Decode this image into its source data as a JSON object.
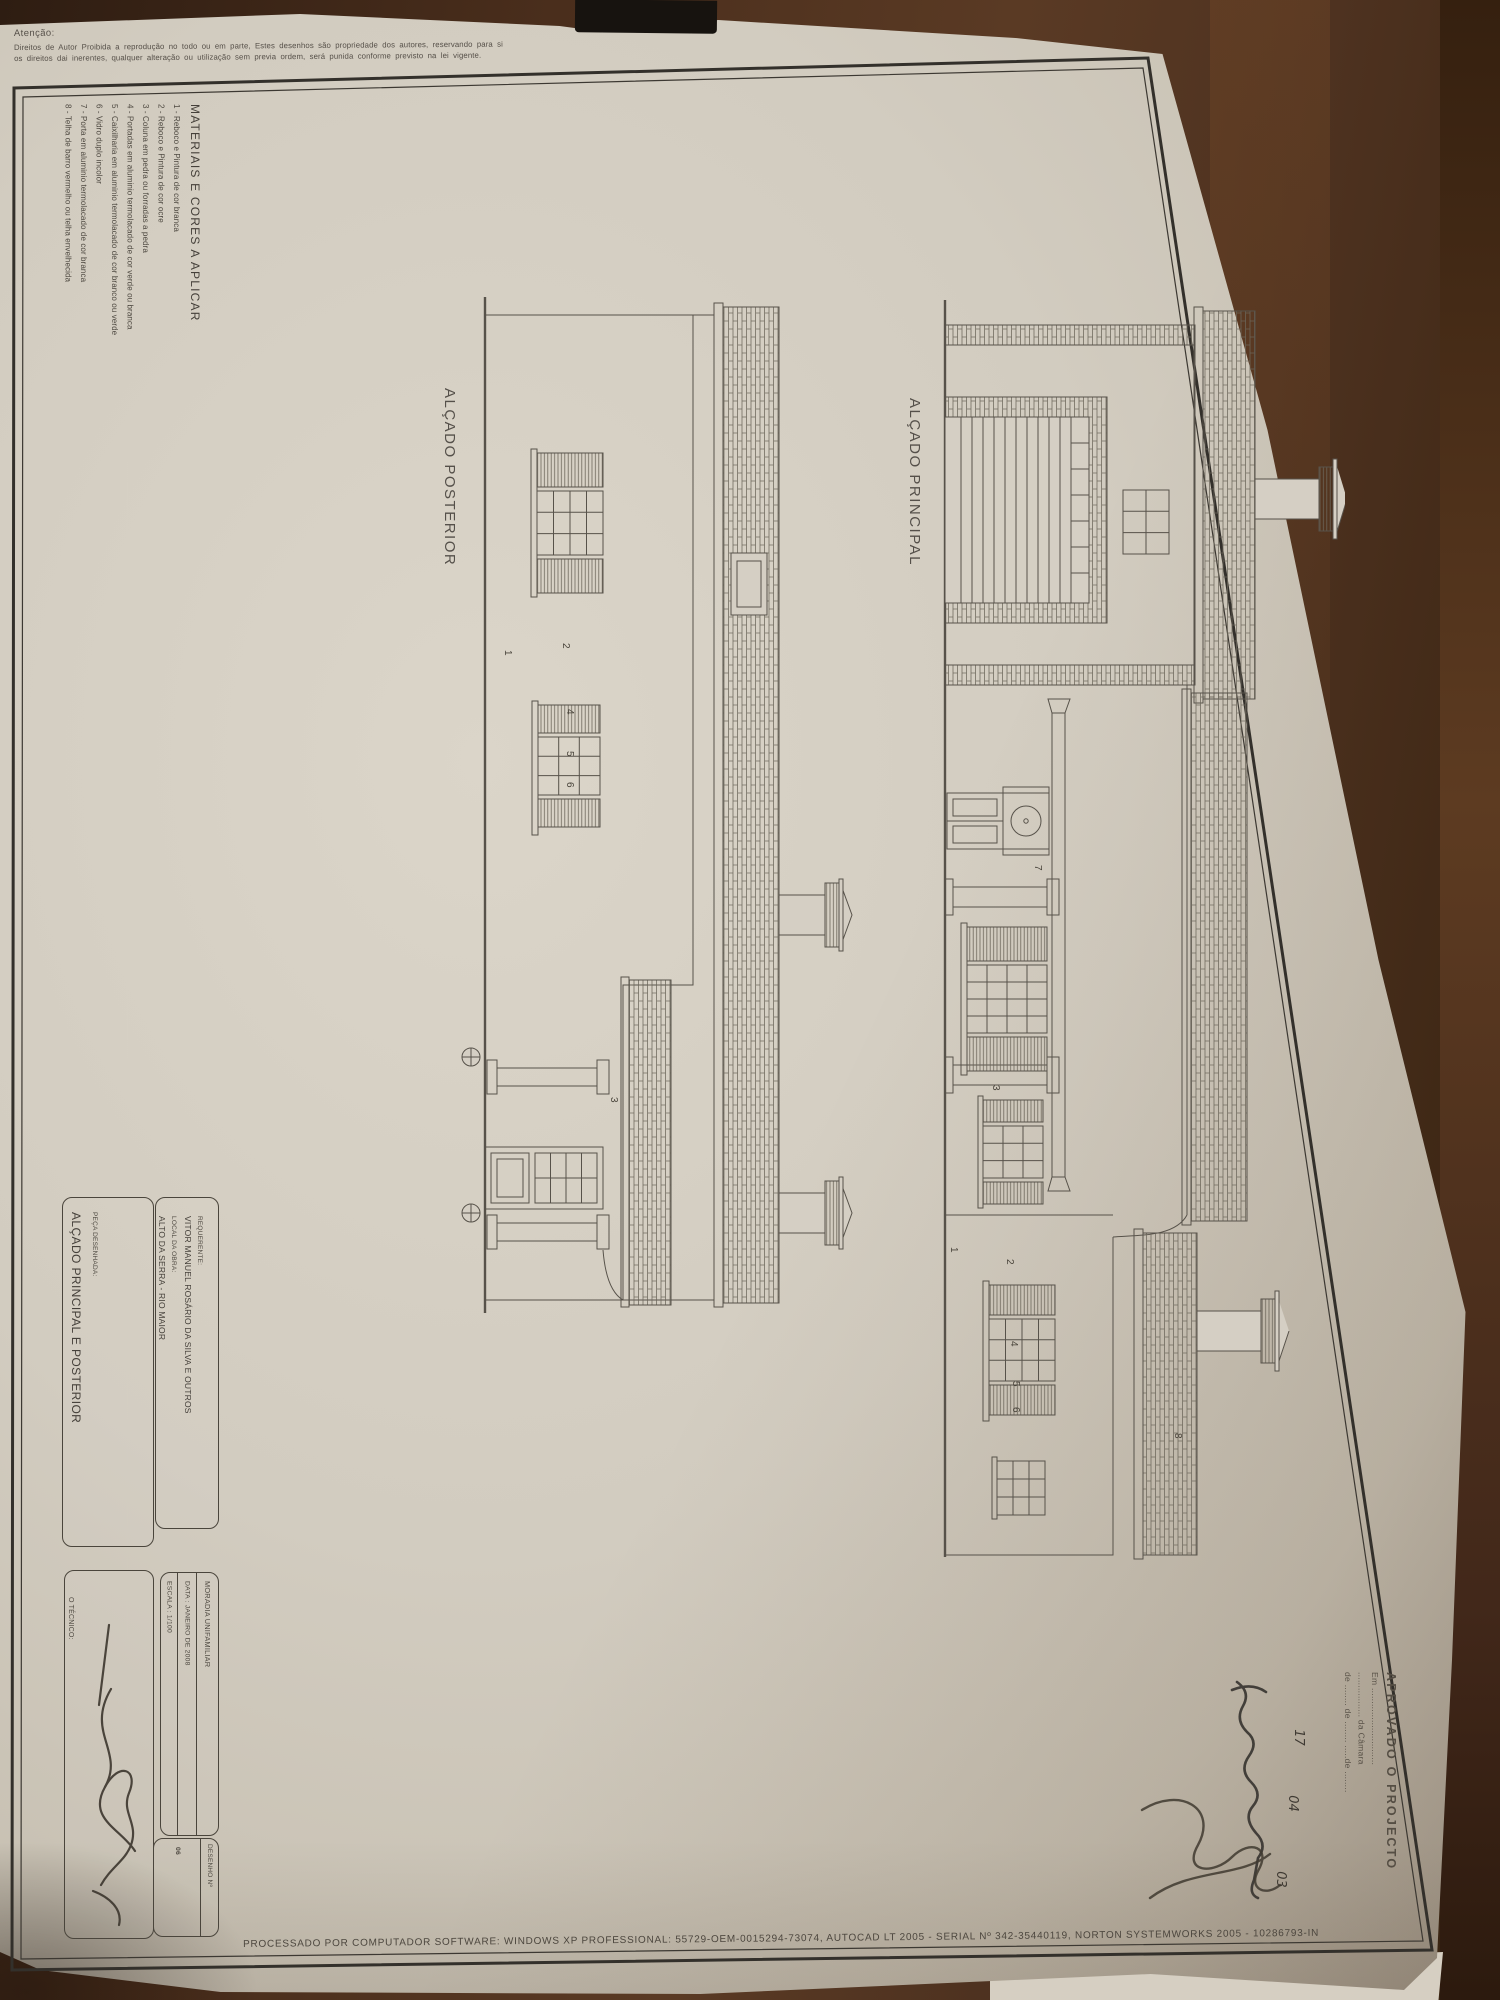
{
  "attention": {
    "title": "Atenção:",
    "line1": "Direitos de Autor Proibida a reprodução no todo ou em parte, Estes desenhos são propriedade dos autores, reservando para si",
    "line2": "os direitos dai inerentes, qualquer alteração ou utilização sem previa ordem, será punida conforme previsto na lei vigente."
  },
  "materials": {
    "heading": "MATERIAIS E CORES A APLICAR",
    "items": [
      "1 - Reboco e Pintura de cor branca",
      "2 - Reboco e Pintura de cor ocre",
      "3 - Coluna em pedra ou forradas a pedra",
      "4 - Portadas em aluminio termolacado de cor verde ou branca",
      "5 - Caixilharia em aluminio termolacado de cor branco ou verde",
      "6 - Vidro duplo incolor",
      "7 - Porta em aluminio termolacado de cor branca",
      "8 - Telha de barro vermelho ou telha envelhecida"
    ]
  },
  "titles": {
    "posterior": "ALÇADO POSTERIOR",
    "principal": "ALÇADO PRINCIPAL"
  },
  "stamp": {
    "heading": "APROVADO O PROJECTO",
    "em_line": "Em .............................",
    "camara_line": "................. da Câmara",
    "date_line": "de ........ de ........ .....de ........",
    "day": "17",
    "month": "04",
    "year": "03"
  },
  "title_block": {
    "requerente_label": "REQUERENTE:",
    "requerente": "VITOR MANUEL ROSÁRIO DA SILVA E OUTROS",
    "local_label": "LOCAL DA OBRA:",
    "local": "ALTO DA SERRA - RIO MAIOR",
    "peca_label": "PEÇA DESENHADA:",
    "peca": "ALÇADO PRINCIPAL E POSTERIOR",
    "moradia": "MORADIA UNIFAMILIAR",
    "data": "DATA : JANEIRO DE 2008",
    "escala": "ESCALA : 1/100",
    "tecnico_label": "O TÉCNICO:",
    "desenho_label": "DESENHO  Nº",
    "desenho_number": "06"
  },
  "footer": {
    "text": "PROCESSADO POR COMPUTADOR SOFTWARE: WINDOWS XP PROFESSIONAL: 55729-OEM-0015294-73074, AUTOCAD LT 2005 - SERIAL Nº 342-35440119, NORTON SYSTEMWORKS 2005 - 10286793-IN"
  },
  "annotations": {
    "posterior": [
      "1",
      "2",
      "4",
      "5",
      "6",
      "3"
    ],
    "principal": [
      "7",
      "3",
      "1",
      "2",
      "4",
      "5",
      "6",
      "8"
    ]
  },
  "colors": {
    "paper": "#d2ccc0",
    "ink": "#57524a",
    "frame": "#33302b",
    "wood": "#4a2e1c"
  }
}
